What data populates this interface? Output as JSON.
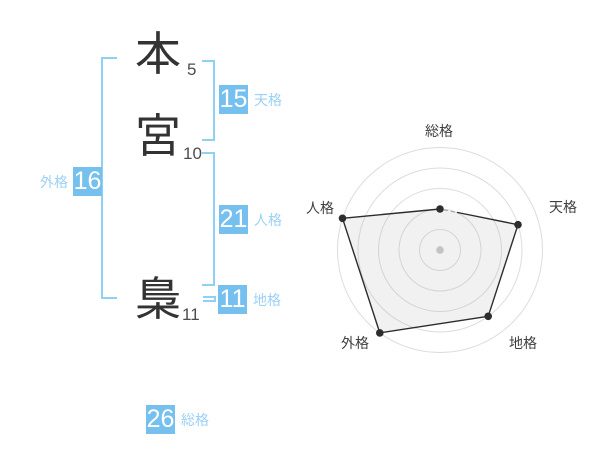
{
  "name_display": {
    "characters": [
      {
        "char": "本",
        "strokes": "5"
      },
      {
        "char": "宮",
        "strokes": "10"
      },
      {
        "char": "梟",
        "strokes": "11"
      }
    ]
  },
  "kaku": {
    "tenkaku": {
      "label": "天格",
      "value": "15"
    },
    "jinkaku": {
      "label": "人格",
      "value": "21"
    },
    "chikaku": {
      "label": "地格",
      "value": "11"
    },
    "gaikaku": {
      "label": "外格",
      "value": "16"
    },
    "soukaku": {
      "label": "総格",
      "value": "26"
    }
  },
  "colors": {
    "badge_blue": "#76c0ef",
    "label_blue": "#9bd1f4",
    "bracket_blue": "#8fd0f5",
    "text_dark": "#333333"
  },
  "chart_data": {
    "type": "radar",
    "title": "",
    "axes": [
      {
        "label": "総格",
        "score": 2,
        "kaku_value": 26
      },
      {
        "label": "天格",
        "score": 4,
        "kaku_value": 15
      },
      {
        "label": "地格",
        "score": 4,
        "kaku_value": 11
      },
      {
        "label": "外格",
        "score": 5,
        "kaku_value": 16
      },
      {
        "label": "人格",
        "score": 5,
        "kaku_value": 21
      }
    ],
    "score_max": 5,
    "rings": 5,
    "start_angle_deg": -90,
    "direction": "clockwise",
    "legend": "none",
    "grid": "concentric-circles",
    "styles": {
      "ring_color": "#dddddd",
      "center_dot_color": "#c9c9c9",
      "series_color": "#2d2d2d",
      "fill_color": "rgba(170,170,170,0.16)",
      "label_color": "#3f3f3f",
      "dashed_segment_color": "#aaaaaa"
    }
  }
}
